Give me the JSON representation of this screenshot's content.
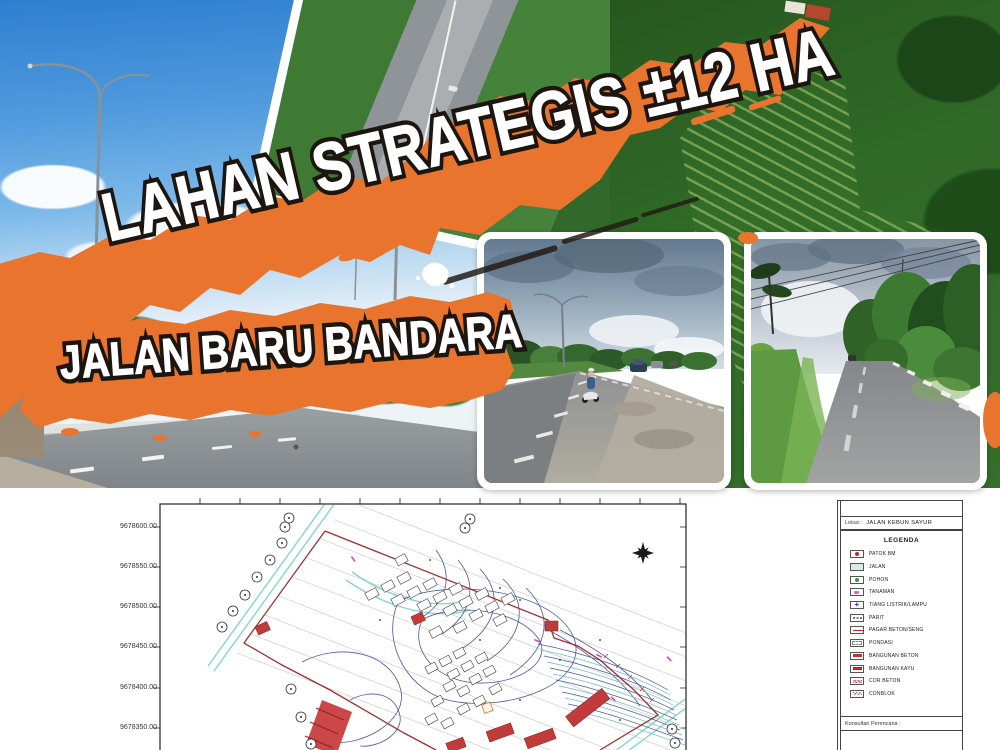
{
  "poster": {
    "headline": "LAHAN STRATEGIS ±12 HA",
    "subheadline": "JALAN BARU BANDARA",
    "accent_color": "#E8742E"
  },
  "site_plan": {
    "y_axis_labels": [
      "9678600.00",
      "9678550.00",
      "9678500.00",
      "9678450.00",
      "9678400.00",
      "9678350.00"
    ],
    "title_block": {
      "location_label": "Lokasi :",
      "location_value": "JALAN KEBUN SAYUR",
      "legend_title": "LEGENDA",
      "consultant_label": "Konsultan Perencana :"
    },
    "legend_items": [
      {
        "label": "PATOK BM"
      },
      {
        "label": "JALAN"
      },
      {
        "label": "POHON"
      },
      {
        "label": "TANAMAN"
      },
      {
        "label": "TIANG LISTRIK/LAMPU"
      },
      {
        "label": "PARIT"
      },
      {
        "label": "PAGAR BETON/SENG"
      },
      {
        "label": "PONDASI"
      },
      {
        "label": "BANGUNAN BETON"
      },
      {
        "label": "BANGUNAN KAYU"
      },
      {
        "label": "COR BETON"
      },
      {
        "label": "CONBLOK"
      }
    ]
  }
}
